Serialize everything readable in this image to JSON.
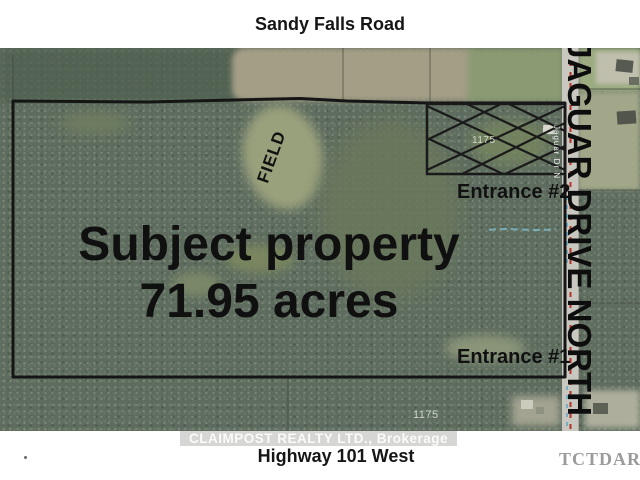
{
  "top_banner": {
    "road_label": "Sandy Falls Road"
  },
  "bottom_banner": {
    "road_label": "Highway 101 West",
    "watermark": "CLAIMPOST REALTY LTD., Brokerage",
    "corner_mark": "TCTDAR"
  },
  "map": {
    "title_line1": "Subject property",
    "title_line2": "71.95 acres",
    "field_label": "FIELD",
    "entrance1_label": "Entrance #1",
    "entrance2_label": "Entrance #2",
    "street_right": "JAGUAR DRIVE NORTH",
    "road_small_label": "Jaguar Dr N",
    "lot_number_top": "1175",
    "lot_number_bottom": "1175"
  },
  "colors": {
    "boundary": "#151515",
    "forest": "#5e6c5f",
    "field": "#a49e86",
    "road_surface": "#c8c7c0",
    "road_centerline_red": "#b23327",
    "utility_blue": "#62aac2",
    "creek_teal": "#7cb6c4",
    "watermark_band": "#d6d6d4",
    "corner_mark_gray": "#9b9b9b"
  }
}
